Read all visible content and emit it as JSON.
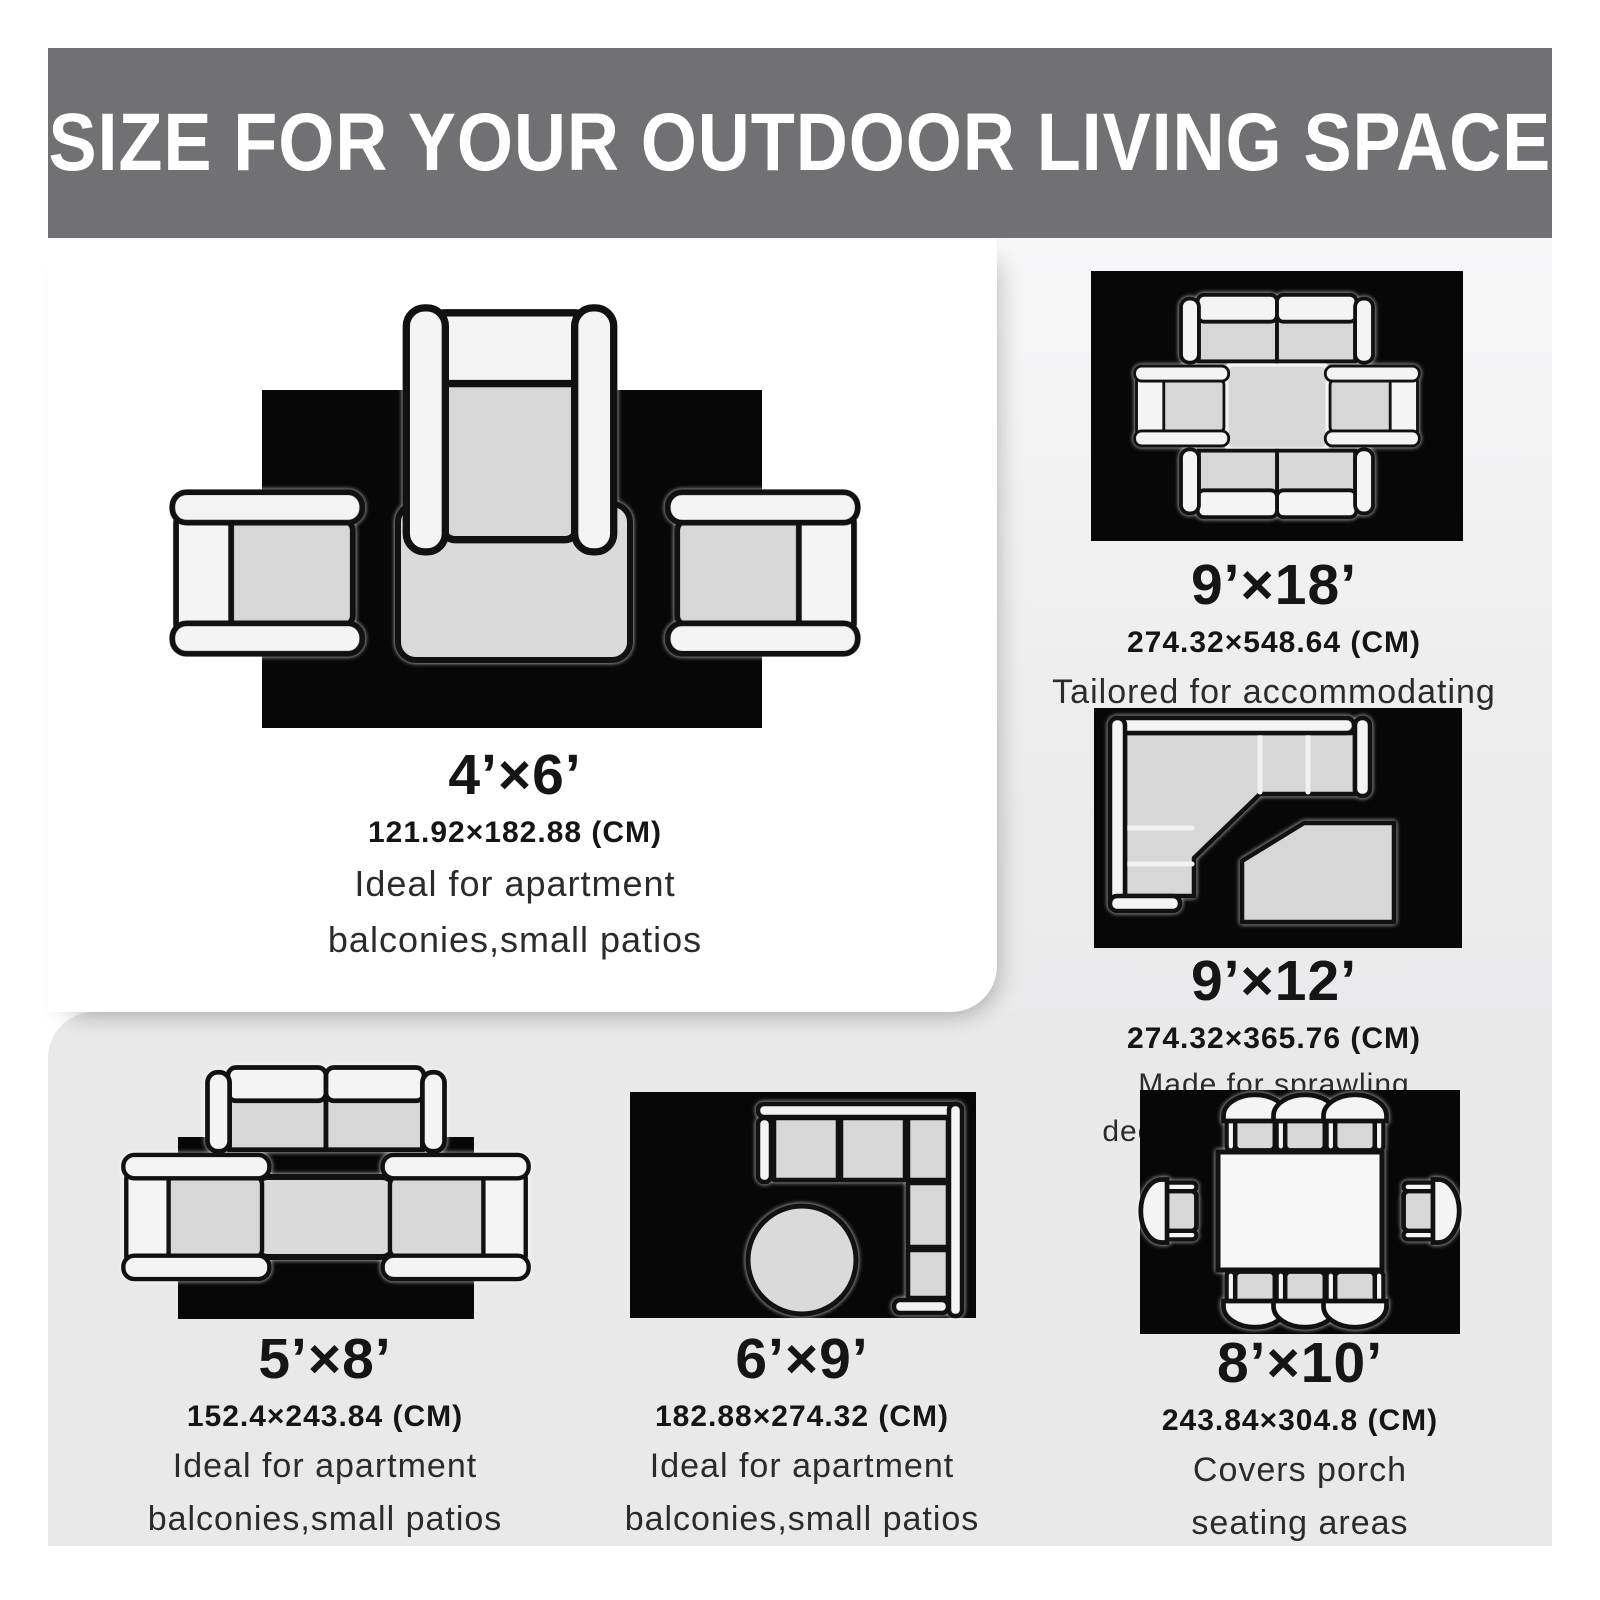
{
  "header": {
    "title": "SIZE FOR YOUR OUTDOOR LIVING SPACE"
  },
  "sections": {
    "s4x6": {
      "size": "4’×6’",
      "cm": "121.92×182.88 (CM)",
      "desc1": "Ideal for apartment",
      "desc2": "balconies,small patios",
      "diagram": "rug-with-three-armchairs-and-coffee-table"
    },
    "s9x18": {
      "size": "9’×18’",
      "cm": "274.32×548.64 (CM)",
      "desc1": "Tailored for accommodating",
      "desc2": "large gatherings",
      "diagram": "rug-with-two-loveseats-two-armchairs-square-table"
    },
    "s9x12": {
      "size": "9’×12’",
      "cm": "274.32×365.76 (CM)",
      "desc1": "Made for sprawling",
      "desc2": "decks,poolside lounging",
      "diagram": "rug-with-corner-sectional-and-table"
    },
    "s5x8": {
      "size": "5’×8’",
      "cm": "152.4×243.84 (CM)",
      "desc1": "Ideal for apartment",
      "desc2": "balconies,small patios",
      "diagram": "rug-with-loveseat-two-armchairs-coffee-table"
    },
    "s6x9": {
      "size": "6’×9’",
      "cm": "182.88×274.32 (CM)",
      "desc1": "Ideal for apartment",
      "desc2": "balconies,small patios",
      "diagram": "rug-with-corner-sectional-and-round-table"
    },
    "s8x10": {
      "size": "8’×10’",
      "cm": "243.84×304.8 (CM)",
      "desc1": "Covers porch",
      "desc2": "seating areas",
      "diagram": "rug-with-dining-table-and-eight-chairs"
    }
  },
  "colors": {
    "header_bg": "#717174",
    "header_text": "#ffffff",
    "rug_black": "#070707",
    "furniture_white": "#f4f4f4",
    "cushion_gray": "#d7d7d8",
    "panel_white": "#ffffff",
    "panel_gray": "#e9e9ea",
    "text_dark": "#151515"
  }
}
